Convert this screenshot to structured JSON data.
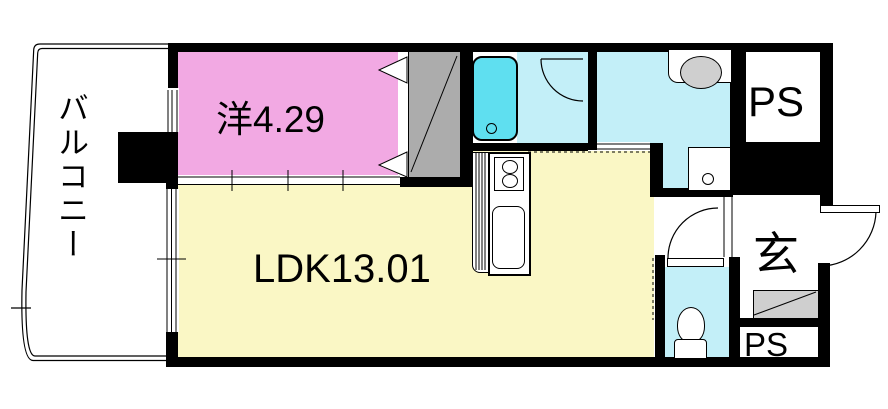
{
  "title": "apartment floor plan",
  "labels": {
    "balcony": "バルコニー",
    "western_room": "洋4.29",
    "ldk": "LDK13.01",
    "entrance": "玄",
    "ps_top": "PS",
    "ps_bottom": "PS"
  },
  "colors": {
    "wall": "#000000",
    "room-pink": "#F2A9E3",
    "room-yellow": "#FAF7C5",
    "water-light": "#C3EFF8",
    "water-bright": "#5FDFF0",
    "closet-gray": "#ACACAC",
    "cabinet-gray": "#CFCFCF"
  }
}
